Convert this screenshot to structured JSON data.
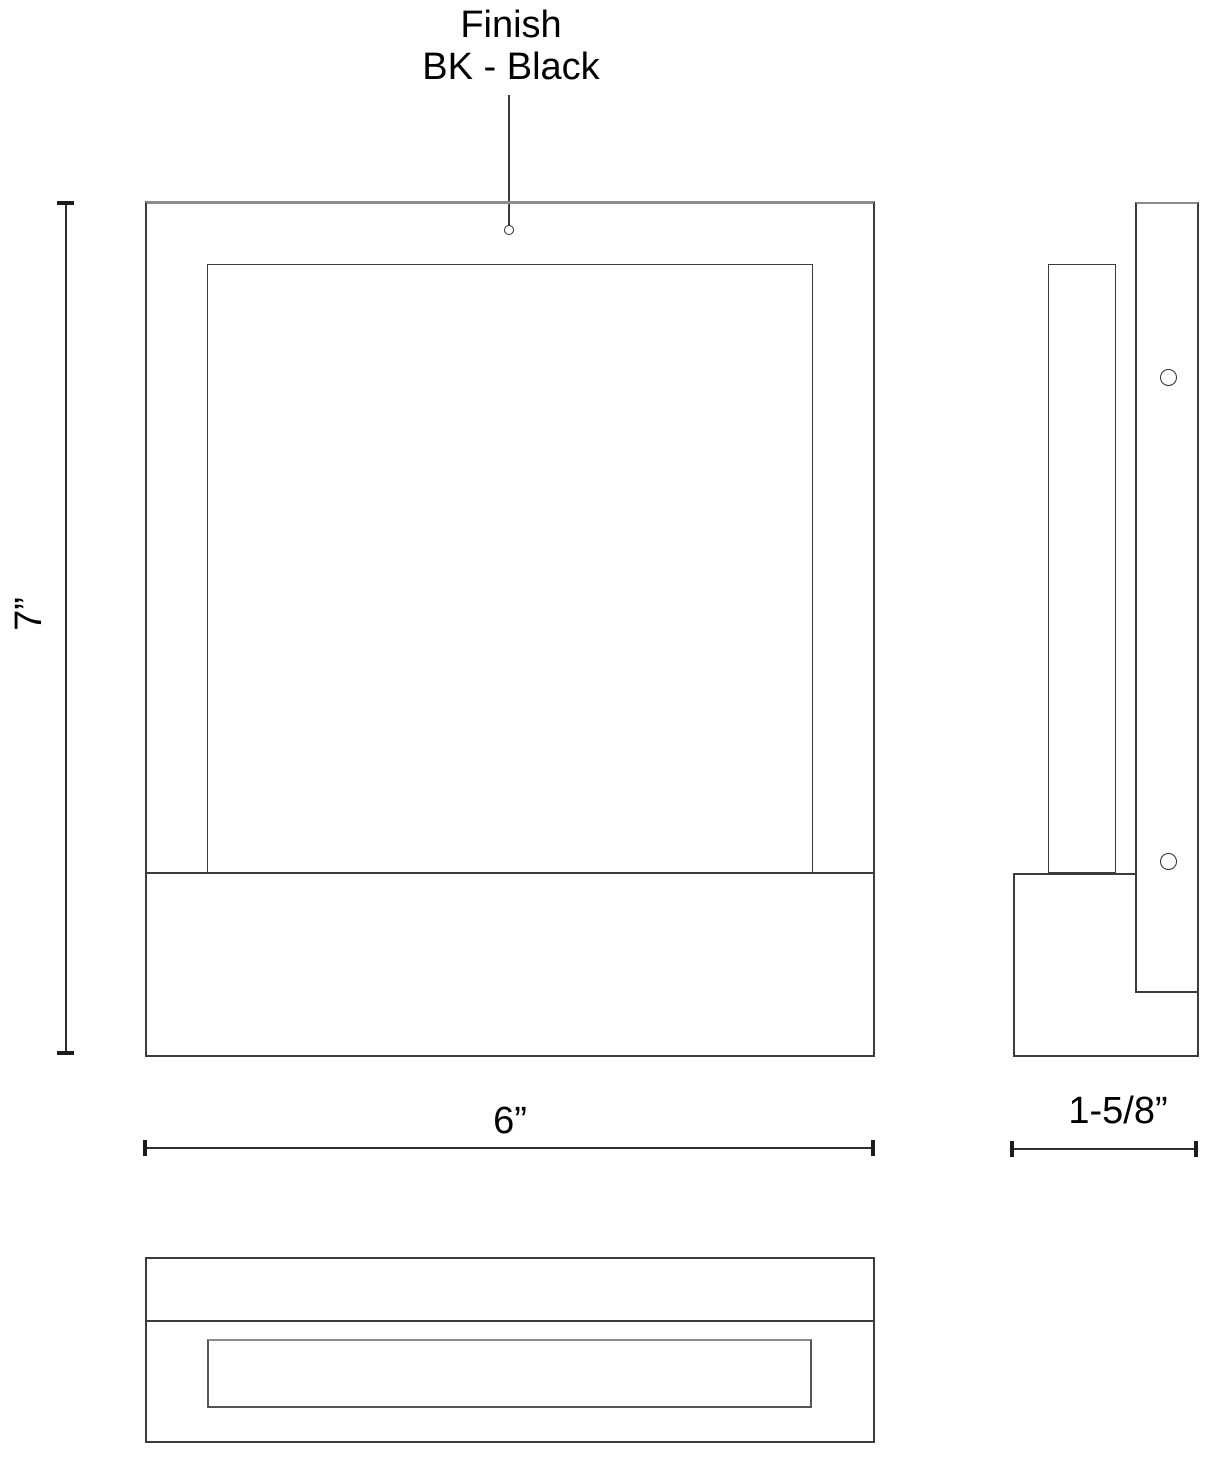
{
  "drawing": {
    "type": "product-dimension-drawing",
    "colors": {
      "line": "#3b3b3b",
      "line_light": "#8c8c8c",
      "dimension_line": "#2f2f2f",
      "text": "#000000",
      "background": "#ffffff"
    },
    "callout": {
      "title": "Finish",
      "value": "BK - Black"
    },
    "dimensions": {
      "height_label": "7”",
      "width_label": "6”",
      "depth_label": "1-5/8”"
    },
    "views": {
      "front": "front-view",
      "side": "side-view",
      "bottom": "bottom-view"
    }
  }
}
